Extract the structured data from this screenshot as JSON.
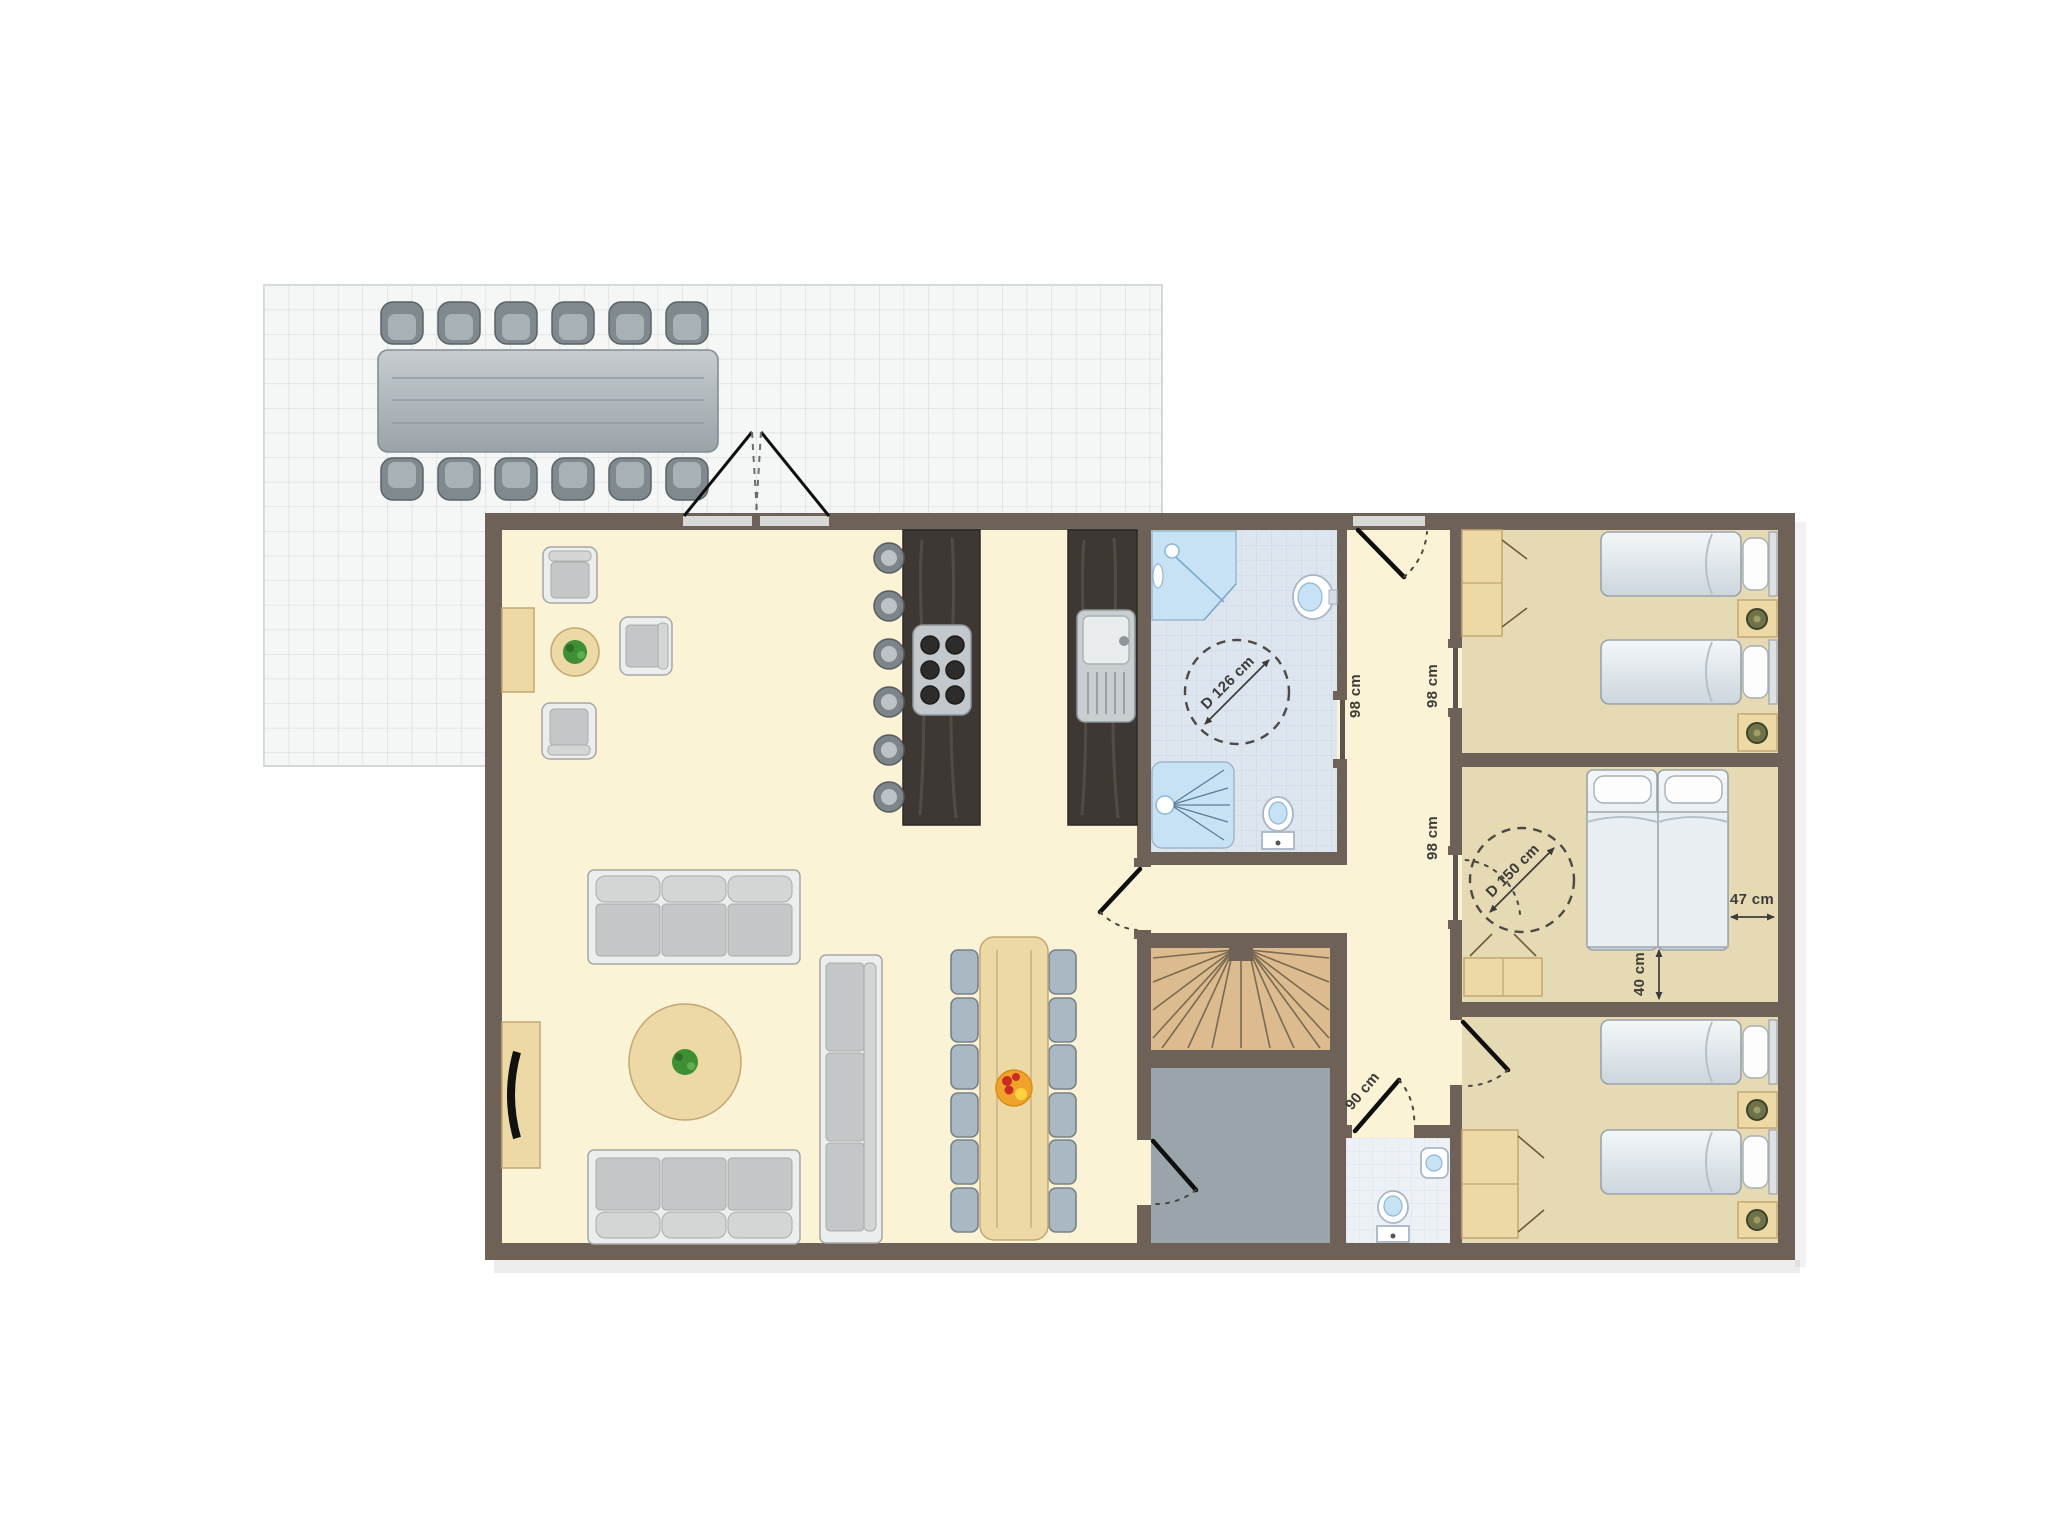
{
  "plan": {
    "type": "floor-plan",
    "rooms": [
      "terrace",
      "living-dining-room",
      "kitchen",
      "bathroom",
      "hallway",
      "staircase",
      "storage-room",
      "wc",
      "bedroom-1",
      "bedroom-2",
      "bedroom-3"
    ]
  },
  "dimensions": {
    "bathroom_turn_circle": "D 126 cm",
    "bathroom_door": "98 cm",
    "bedroom1_door": "98 cm",
    "bedroom2_door": "98 cm",
    "bedroom2_turn_circle": "D 150 cm",
    "bed_side_clearance": "47 cm",
    "bed_foot_clearance": "40 cm",
    "wc_door": "90 cm"
  },
  "colors": {
    "wall": "#6e6158",
    "living_floor": "#fbf3d6",
    "bedroom_floor": "#e5dab4",
    "bathroom_floor": "#dde5ef",
    "wc_floor": "#edf1f6",
    "terrace_floor": "#f5f6f6",
    "storage_floor": "#99a4ab",
    "stairs_wood": "#dcbc8e",
    "counter_dark": "#3d3834",
    "furniture_wood": "#ecd9a6",
    "sofa_gray": "#c4c7c7",
    "dining_chair_blue": "#a9b8c2",
    "fixture_blue": "#c6e2f4",
    "plant_green": "#3f8f35",
    "fruit_orange": "#f0a32b"
  }
}
